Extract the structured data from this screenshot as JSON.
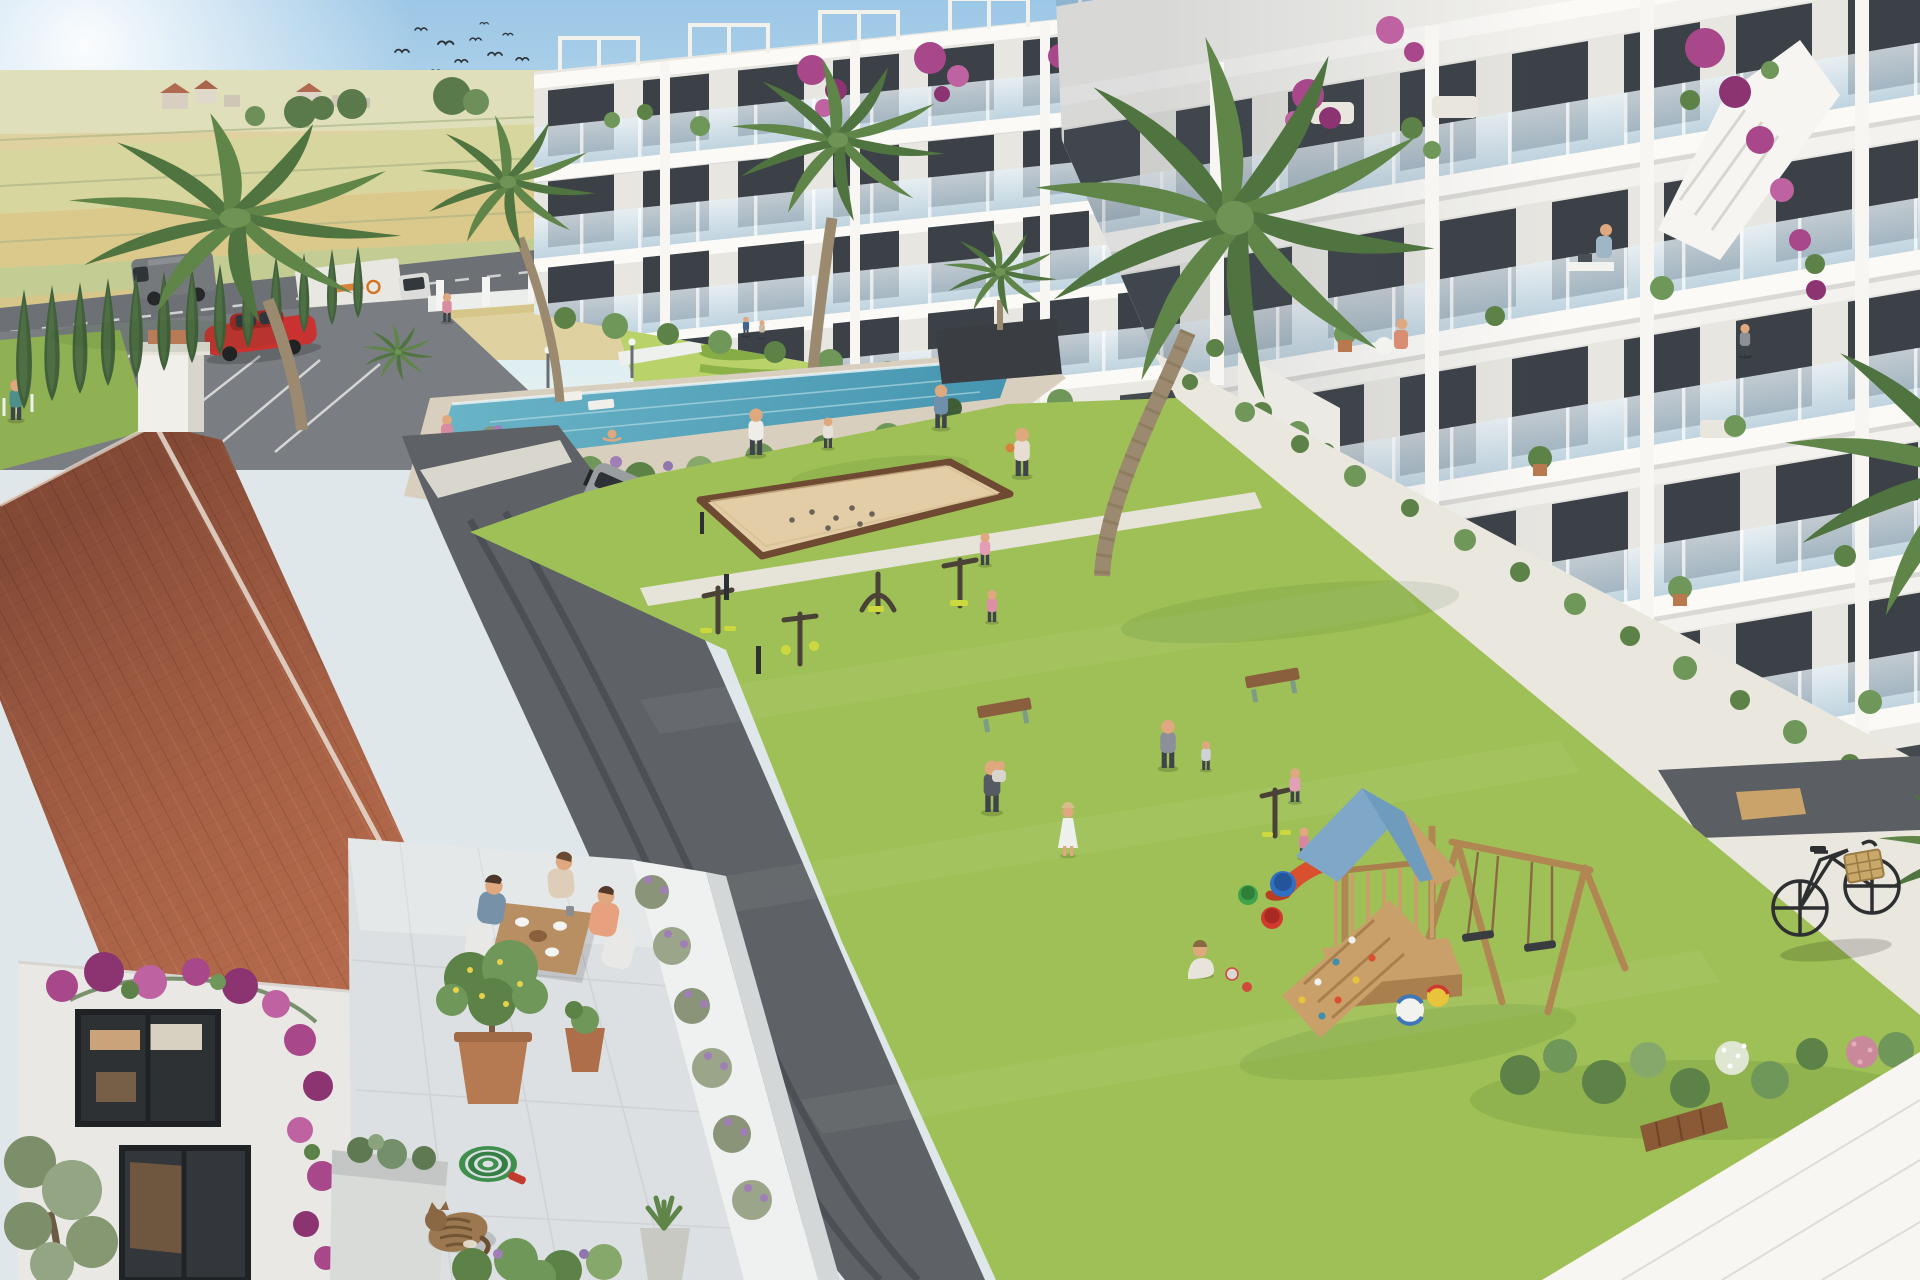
{
  "scene": {
    "type": "photorealistic architectural rendering, aerial three-quarter view",
    "subject": "Mediterranean new-build residential complex with landscaped courtyard",
    "weather": "sunny, clear sky with sun glare at top-left",
    "sky": {
      "birds_in_flock": 11
    },
    "background": {
      "countryside": "golden wheat and green farmland strips",
      "village": "small distant farmhouses with red roofs",
      "trees": "scattered leafy trees along the horizon"
    },
    "highway": {
      "vehicles": [
        {
          "type": "panel-van",
          "color": "gray"
        },
        {
          "type": "box-truck",
          "color": "white with orange logo"
        },
        {
          "type": "parked-car",
          "color": "red"
        }
      ],
      "edging": "cypress row and white pillar fence"
    },
    "buildings": {
      "apartment_blocks": 2,
      "floors_visible": 5,
      "facade": "white stepped terraces, glass balcony railings, dark window frames",
      "balcony_details": [
        "potted plants",
        "bougainvillea cascades",
        "outdoor furniture",
        "roof pergolas"
      ],
      "balcony_people": [
        "man working at a desk",
        "woman seated at a table",
        "woman standing"
      ]
    },
    "amenities": {
      "swimming_pool": {
        "swimmers": 3,
        "deck": "beige stone",
        "garden": "ornamental mowed lawn swirls, black planter with palm"
      },
      "petanque_court": {
        "surface": "sand",
        "border": "wood",
        "boules": 7
      },
      "outdoor_gym": {
        "machines": 5,
        "accent_color_name": "yellow-green"
      },
      "playground": {
        "tower_roof": "blue",
        "features": [
          "climbing wall with holds",
          "red slide",
          "double swing set"
        ],
        "toys": [
          "beach ball",
          "yellow ball",
          "three buckets"
        ]
      },
      "benches": 2
    },
    "courtyard": {
      "lawn": "large central green",
      "paths": "light concrete walkways",
      "road": "dark asphalt with curved tire marks and bollard lights",
      "parked_suv": "silver"
    },
    "foreground_house": {
      "style": "Spanish villa",
      "roof": "terracotta barrel tiles with white chimney",
      "terrace": {
        "diners": 3,
        "table": "wood with breakfast set",
        "lemon_tree_in_pot": true,
        "lavender_row": true
      },
      "details": [
        "sleeping tabby cat",
        "coiled green garden hose with red nozzle",
        "bougainvillea on white wall",
        "olive tree",
        "aloe pot"
      ]
    },
    "right_edge": {
      "bicycle": "black city bike with wicker basket",
      "palm_fronds_overhang": true,
      "white_rooftop_foreground": true
    },
    "people_total_approx": 22
  },
  "colors": {
    "sky_top": "#9cc7e6",
    "sky_horizon": "#ecf5f5",
    "sun_glow": "#ffffff",
    "field_far": "#dfe0bb",
    "field_gold": "#e0d2a0",
    "field_wheat": "#dbc98c",
    "field_green": "#c3cd93",
    "highway_asphalt": "#6d7175",
    "parking_asphalt": "#7a7e82",
    "court_road": "#5e6266",
    "lawn_main": "#9fc056",
    "lawn_art": "#b9d36a",
    "hedge_green": "#79a23e",
    "pool_water": "#5aa9bf",
    "pool_deck": "#d9cfbe",
    "sand_court": "#e2cda7",
    "court_border": "#6e4a33",
    "roof_tile": "#b0674e",
    "roof_tile_dark": "#8a4f3d",
    "terrace_tile": "#dde0e2",
    "terrace_wall": "#eff1f1",
    "building_white": "#f3f2ee",
    "window_dark": "#3b4147",
    "balcony_glass": "#cfe2ee",
    "play_roof_blue": "#7fa8c8",
    "play_wood": "#c9a06a",
    "slide_red": "#d8502e",
    "gym_yellow": "#cbd93e",
    "bench_wood": "#8a5f3e",
    "suv_silver": "#9a9ea1",
    "truck_white": "#e9e7e2",
    "van_gray": "#75797c",
    "car_red": "#c93230",
    "bike_black": "#2e2f31",
    "basket_tan": "#c9a86a",
    "cat_brown": "#9c7850",
    "hose_green": "#3f8f4f",
    "bougainvillea": "#a8478a",
    "lavender": "#9f7fb5",
    "palm_green": "#5f8549",
    "cypress_green": "#42603c",
    "walkway": "#eae7df",
    "path_light": "#e6e3d8",
    "dirt_path": "#c09272",
    "foreground_roof": "#f7f6f2"
  }
}
